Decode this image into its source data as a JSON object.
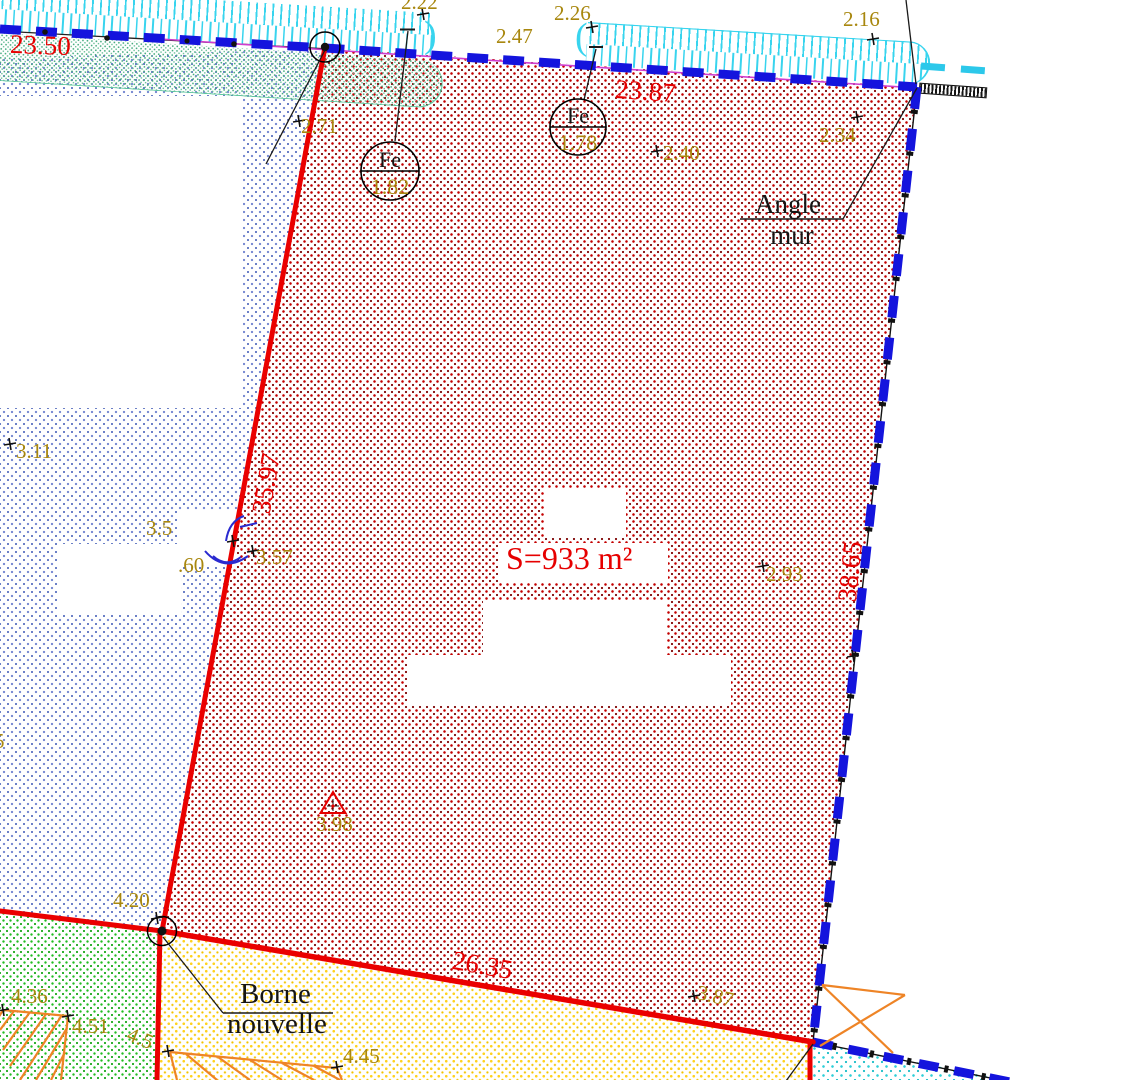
{
  "parcel": {
    "area_label": "S=933 m²"
  },
  "dimensions": {
    "top_left": "23.50",
    "top": "23.87",
    "left": "35.97",
    "right": "38.65",
    "bottom": "26.35"
  },
  "measures": {
    "m222": "2.22",
    "m247": "2.47",
    "m226": "2.26",
    "m216": "2.16",
    "m271": "2.71",
    "m240": "2.40",
    "m234": "2.34",
    "m311": "3.11",
    "m35": "3.5",
    "m60": ".60",
    "m357": "3.57",
    "m293": "2.93",
    "m398": "3.98",
    "m420": "4.20",
    "m387": "3.87",
    "m436": "4.36",
    "m451": "4.51",
    "m45": "4.5",
    "m445": "4.45",
    "m5": "5"
  },
  "markers": {
    "fe1_label": "Fe",
    "fe1_value": "1.82",
    "fe2_label": "Fe",
    "fe2_value": "1.78"
  },
  "notes": {
    "angle_1": "Angle",
    "angle_2": "mur",
    "borne_1": "Borne",
    "borne_2": "nouvelle"
  },
  "glyphs": {
    "paren_open": "(",
    "paren_close": ")"
  },
  "colors": {
    "parcel_line_red": "#e60000",
    "limit_blue": "#1414dd",
    "hedge_cyan": "#38d4ee",
    "measure_gold": "#a8870e",
    "fence_orange": "#ee8426",
    "magenta_line": "#cf3ecf"
  }
}
